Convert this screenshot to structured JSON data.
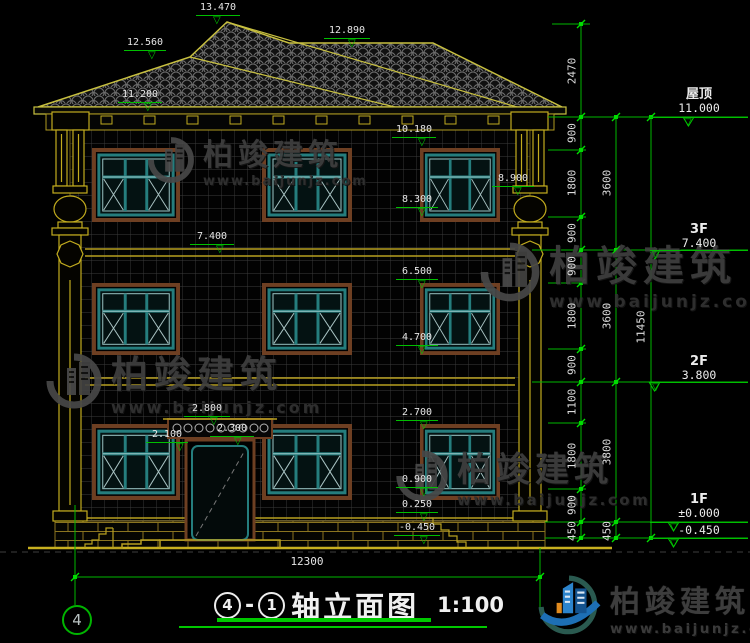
{
  "brand": {
    "name": "柏竣建筑",
    "url": "www.baijunjz.com"
  },
  "title": {
    "axis_from": "4",
    "separator": "-",
    "axis_to": "1",
    "name": "轴立面图",
    "scale": "1:100"
  },
  "axis_bubble_bottom_left": "4",
  "dims": {
    "bottom_overall": "12300",
    "right_chain_inner": [
      "2470",
      "900",
      "1800",
      "900",
      "900",
      "1800",
      "900",
      "1100",
      "1800",
      "900",
      "450"
    ],
    "right_chain_mid": [
      "3600",
      "3600",
      "3800",
      "450"
    ],
    "right_overall": "11450"
  },
  "levels": [
    {
      "label": "屋顶",
      "value": "11.000"
    },
    {
      "label": "3F",
      "value": "7.400"
    },
    {
      "label": "2F",
      "value": "3.800"
    },
    {
      "label": "1F",
      "value": "±0.000"
    },
    {
      "label": "",
      "value": "-0.450"
    }
  ],
  "elevation_markers": {
    "roof_peak": "13.470",
    "roof_ridge": "12.890",
    "roof_hip": "12.560",
    "eave": "11.200",
    "f3_window_top": "10.180",
    "column_capital": "8.900",
    "f3_window_sill": "8.300",
    "f3_floor": "7.400",
    "f2_window_top": "6.500",
    "f2_window_sill": "4.700",
    "f1_window_top": "2.700",
    "canopy_top": "2.800",
    "canopy_bottom": "2.300",
    "door_top": "2.100",
    "f1_window_sill": "0.900",
    "plinth_top": "0.250",
    "outdoor_ground": "-0.450"
  },
  "icons": {
    "level_marker": "▽"
  }
}
